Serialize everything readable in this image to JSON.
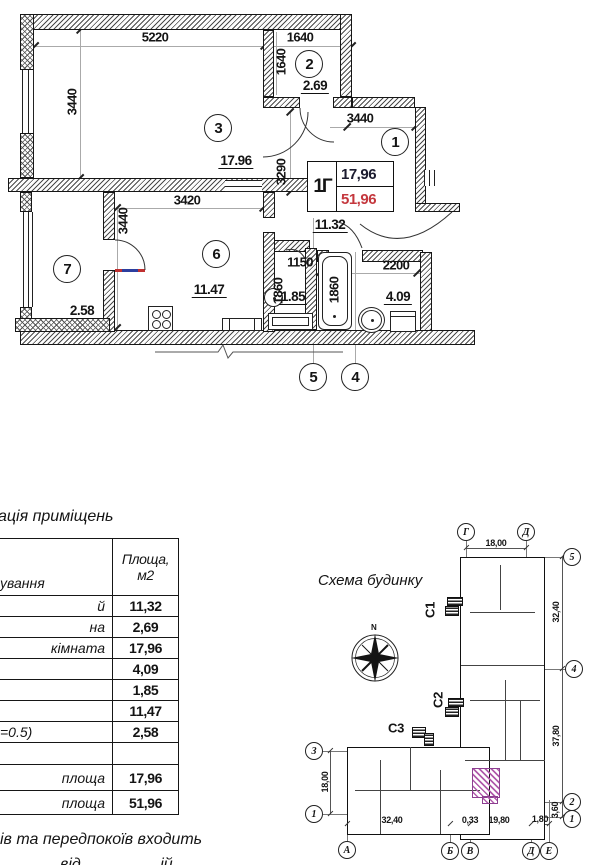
{
  "plan": {
    "room_numbers": {
      "r1": "1",
      "r2": "2",
      "r3": "3",
      "r4": "4",
      "r5": "5",
      "r6": "6",
      "r7": "7"
    },
    "areas": {
      "room2": "2.69",
      "room3": "17.96",
      "hall": "11.32",
      "room4": "4.09",
      "room5": "1.85",
      "room6": "11.47",
      "room7": "2.58"
    },
    "dimensions": {
      "top_width": "5220",
      "top_right_width": "1640",
      "right_room_height": "1640",
      "left_height": "3440",
      "lobby_width": "3440",
      "hall_height": "3290",
      "kitchen_width": "3420",
      "kitchen_height": "3440",
      "wc_width": "1150",
      "wc_depth": "1860",
      "bath_length": "1860",
      "bath_width": "2200"
    },
    "stamp": {
      "unit": "1Г",
      "upper_area": "17,96",
      "total_area": "51,96"
    }
  },
  "table": {
    "title_fragment": "ація приміщень",
    "name_header_fragment": "ування",
    "area_header_line1": "Площа,",
    "area_header_line2": "м2",
    "rows": [
      {
        "label": "й",
        "value": "11,32"
      },
      {
        "label": "на",
        "value": "2,69"
      },
      {
        "label": "кімната",
        "value": "17,96"
      },
      {
        "label": "",
        "value": "4,09"
      },
      {
        "label": "",
        "value": "1,85"
      },
      {
        "label": "",
        "value": "11,47"
      },
      {
        "label": "=0.5)",
        "value": "2,58"
      },
      {
        "label": "",
        "value": ""
      },
      {
        "label": "площа",
        "value": "17,96"
      },
      {
        "label": "площа",
        "value": "51,96"
      }
    ],
    "footnote_line1": "ів та передпокоїв входить",
    "footnote_line2_fragment": "від ій"
  },
  "scheme": {
    "title": "Схема будинку",
    "north_label": "N",
    "sections": {
      "s1": "С1",
      "s2": "С2",
      "s3": "С3"
    },
    "axis_circles": {
      "top": [
        "Г",
        "Д"
      ],
      "right": [
        "5",
        "4",
        "2",
        "1"
      ],
      "left": [
        "З",
        "1"
      ],
      "bottom": [
        "А",
        "Б",
        "В",
        "Д",
        "Е"
      ]
    },
    "dimensions": {
      "top": "18,00",
      "right_upper": "32,40",
      "right_lower": "37,80",
      "right_corner": "3,60",
      "left": "18,00",
      "bottom_left": "32,40",
      "bottom_gap": "0,33",
      "bottom_mid": "19,80",
      "bottom_right": "1,80"
    }
  },
  "colors": {
    "total_area_red": "#c4373d",
    "highlight_pink": "#b15bac",
    "leaf_red": "#c03030",
    "leaf_blue": "#2c3e9e"
  }
}
